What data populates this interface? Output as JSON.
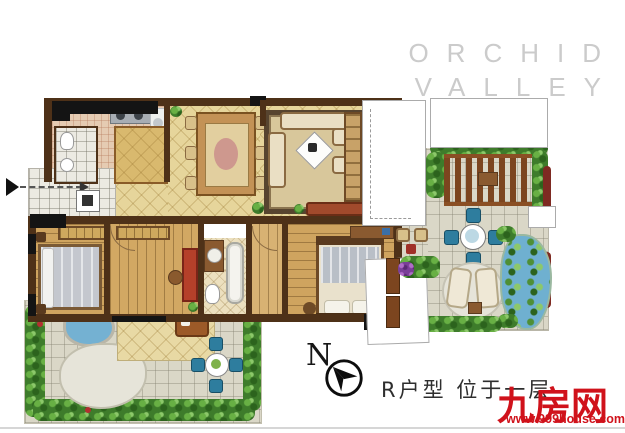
{
  "brand": {
    "line1": "ORCHID",
    "line2": "VALLEY"
  },
  "compass": {
    "label": "N"
  },
  "caption": {
    "text": "R户型  位于一层"
  },
  "watermark": {
    "name": "九房网",
    "url": "www.999house.com"
  },
  "palette": {
    "wall": "#4e3118",
    "tile": "#e6d59b",
    "wood": "#cfa45f",
    "paving": "#dad7c7",
    "green": "#3e7c2b",
    "water": "#74b1d2",
    "red": "#d0121b",
    "logoGray": "#cbcbcb",
    "ink": "#2e2e2e"
  }
}
